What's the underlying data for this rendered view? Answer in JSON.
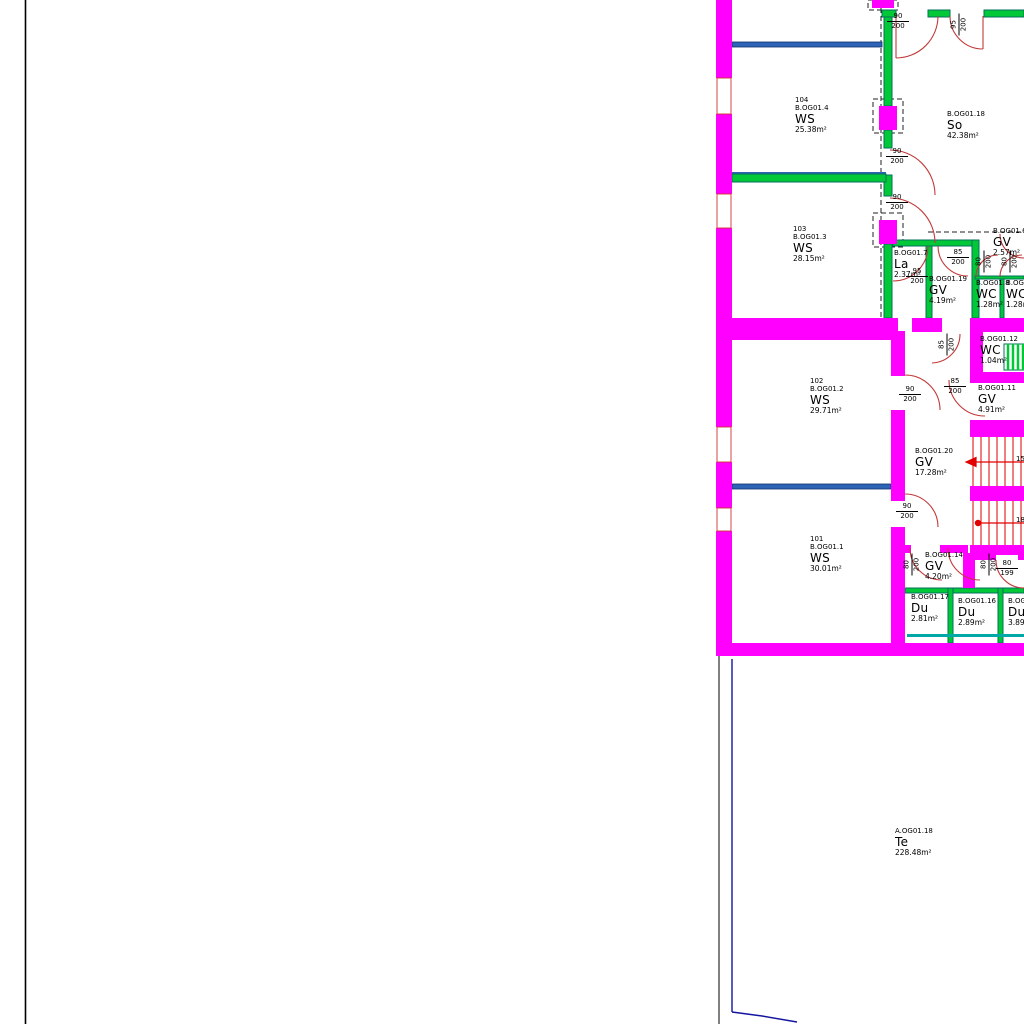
{
  "drawing": {
    "kind": "architectural floor plan (CAD)",
    "floor_code_prefix": "B.OG01 / A.OG01"
  },
  "colors": {
    "wall_magenta": "#FF00FF",
    "partition_green": "#00C837",
    "partition_edge": "#066F5F",
    "door_swing_red": "#C23A3A",
    "window_blue": "#2E64B5",
    "stair_red": "#E00000",
    "terrace_navy": "#1414A0",
    "duct_teal": "#00A8A8",
    "line_black": "#000000"
  },
  "rooms": [
    {
      "number": "104",
      "code": "B.OG01.4",
      "name": "WS",
      "area": "25.38m²"
    },
    {
      "code": "B.OG01.18",
      "name": "So",
      "area": "42.38m²"
    },
    {
      "number": "103",
      "code": "B.OG01.3",
      "name": "WS",
      "area": "28.15m²"
    },
    {
      "code": "B.OG01.7",
      "name": "La",
      "area": "2.37m²"
    },
    {
      "code": "B.OG01.19",
      "name": "GV",
      "area": "4.19m²"
    },
    {
      "code": "B.OG01.6",
      "name": "GV",
      "area": "2.57m²"
    },
    {
      "code": "B.OG01.8",
      "name": "WC",
      "area": "1.28m²"
    },
    {
      "code": "B.OG01.9",
      "name": "WC",
      "area": "1.28m²"
    },
    {
      "code": "B.OG01.12",
      "name": "WC",
      "area": "1.04m²"
    },
    {
      "code": "B.OG01.11",
      "name": "GV",
      "area": "4.91m²"
    },
    {
      "number": "102",
      "code": "B.OG01.2",
      "name": "WS",
      "area": "29.71m²"
    },
    {
      "code": "B.OG01.20",
      "name": "GV",
      "area": "17.28m²"
    },
    {
      "number": "101",
      "code": "B.OG01.1",
      "name": "WS",
      "area": "30.01m²"
    },
    {
      "code": "B.OG01.14",
      "name": "GV",
      "area": "4.20m²"
    },
    {
      "code": "B.OG01.17",
      "name": "Du",
      "area": "2.81m²"
    },
    {
      "code": "B.OG01.16",
      "name": "Du",
      "area": "2.89m²"
    },
    {
      "code": "B.OG01.15",
      "name": "Du",
      "area": "3.89m²"
    },
    {
      "code": "A.OG01.18",
      "name": "Te",
      "area": "228.48m²"
    }
  ],
  "door_labels": [
    {
      "num": "90",
      "den": "200"
    },
    {
      "num": "95",
      "den": "200"
    },
    {
      "num": "90",
      "den": "200"
    },
    {
      "num": "90",
      "den": "200"
    },
    {
      "num": "95",
      "den": "200"
    },
    {
      "num": "85",
      "den": "200"
    },
    {
      "num": "80",
      "den": "200"
    },
    {
      "num": "80",
      "den": "200"
    },
    {
      "num": "85",
      "den": "200"
    },
    {
      "num": "85",
      "den": "200"
    },
    {
      "num": "90",
      "den": "200"
    },
    {
      "num": "90",
      "den": "200"
    },
    {
      "num": "80",
      "den": "200"
    },
    {
      "num": "80",
      "den": "200"
    },
    {
      "num": "80",
      "den": "199"
    }
  ],
  "stair": {
    "step_numbers": [
      "15",
      "18"
    ]
  }
}
